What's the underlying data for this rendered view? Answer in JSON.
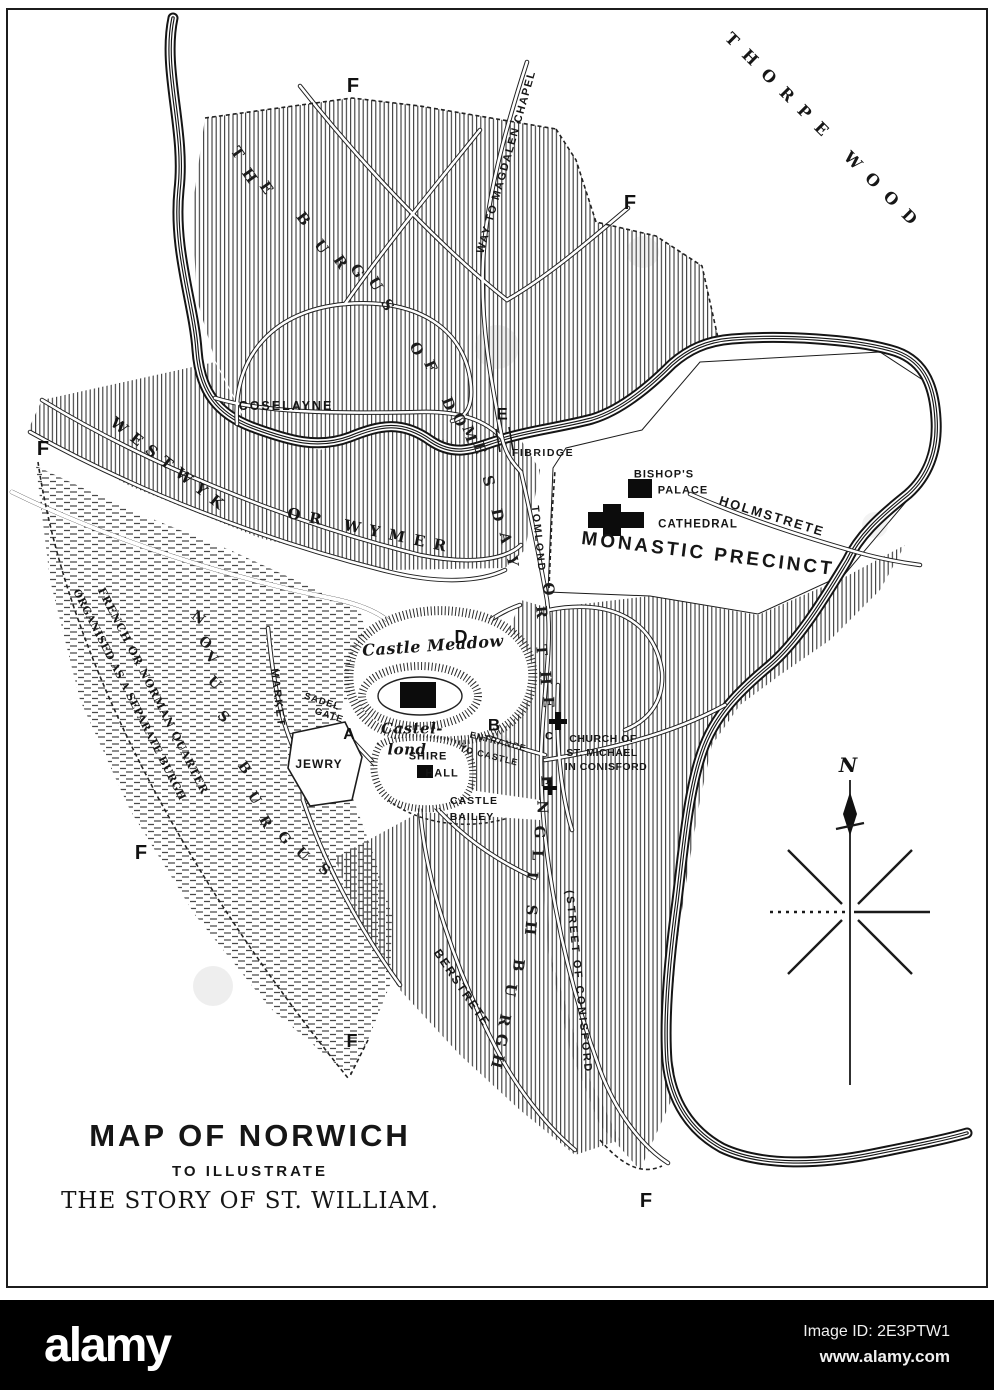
{
  "colors": {
    "ink": "#1a1a1a",
    "paper": "#ffffff",
    "bar": "#000000"
  },
  "title_block": {
    "line1": "MAP OF NORWICH",
    "line2": "TO ILLUSTRATE",
    "line3": "THE STORY OF ST. WILLIAM."
  },
  "compass": {
    "north_label": "N"
  },
  "watermark_bar": {
    "logo": "alamy",
    "image_id": "Image ID: 2E3PTW1",
    "url": "www.alamy.com"
  },
  "map_labels": [
    {
      "id": "thorpe-wood",
      "text": "THORPE WOOD",
      "x": 825,
      "y": 133,
      "r": 45,
      "fs": 16,
      "ls": 12,
      "cls": "serifb"
    },
    {
      "id": "way-to-magdalen-chapel",
      "text": "WAY TO MAGDALEN CHAPEL",
      "x": 507,
      "y": 162,
      "r": -74,
      "fs": 11,
      "ls": 1.5,
      "cls": "sansb"
    },
    {
      "id": "coselayne",
      "text": "COSELAYNE",
      "x": 286,
      "y": 406,
      "r": 0,
      "fs": 12.5,
      "ls": 2,
      "cls": "sansb"
    },
    {
      "id": "fibridge",
      "text": "FIBRIDGE",
      "x": 543,
      "y": 453,
      "r": 0,
      "fs": 10.5,
      "ls": 1.5,
      "cls": "sansb"
    },
    {
      "id": "bishops-palace-1",
      "text": "BISHOP'S",
      "x": 664,
      "y": 475,
      "r": 0,
      "fs": 11,
      "ls": 1,
      "cls": "sansb"
    },
    {
      "id": "bishops-palace-2",
      "text": "PALACE",
      "x": 683,
      "y": 491,
      "r": 0,
      "fs": 11,
      "ls": 1,
      "cls": "sansb"
    },
    {
      "id": "holmstrete",
      "text": "HOLMSTRETE",
      "x": 772,
      "y": 516,
      "r": 17,
      "fs": 13,
      "ls": 2,
      "cls": "sansb"
    },
    {
      "id": "cathedral",
      "text": "CATHEDRAL",
      "x": 698,
      "y": 525,
      "r": 0,
      "fs": 11.5,
      "ls": 1,
      "cls": "sansb"
    },
    {
      "id": "monastic-precinct",
      "text": "MONASTIC PRECINCT",
      "x": 708,
      "y": 554,
      "r": 7,
      "fs": 19,
      "ls": 3,
      "cls": "sansb"
    },
    {
      "id": "westwyk",
      "text": "WESTWYK",
      "x": 170,
      "y": 466,
      "r": 38,
      "fs": 15,
      "ls": 8,
      "cls": "serifb"
    },
    {
      "id": "or-wymer",
      "text": "OR WYMER",
      "x": 371,
      "y": 531,
      "r": 12,
      "fs": 15,
      "ls": 9,
      "cls": "serifb"
    },
    {
      "id": "market",
      "text": "MARKET",
      "x": 277,
      "y": 698,
      "r": 83,
      "fs": 11,
      "ls": 2,
      "cls": "sansb"
    },
    {
      "id": "sadelgate-1",
      "text": "SADEL",
      "x": 322,
      "y": 702,
      "r": 18,
      "fs": 9.5,
      "ls": 1,
      "cls": "sansb"
    },
    {
      "id": "sadelgate-2",
      "text": "GATE",
      "x": 329,
      "y": 716,
      "r": 18,
      "fs": 9.5,
      "ls": 1,
      "cls": "sansb"
    },
    {
      "id": "jewry",
      "text": "JEWRY",
      "x": 319,
      "y": 764,
      "r": 0,
      "fs": 12,
      "ls": 1,
      "cls": "sansb"
    },
    {
      "id": "castle-meadow",
      "text": "Castle Meadow",
      "x": 433,
      "y": 646,
      "r": -4,
      "fs": 16,
      "ls": 0.5,
      "cls": "serifbi"
    },
    {
      "id": "castel-lond-1",
      "text": "Castel-",
      "x": 412,
      "y": 729,
      "r": 0,
      "fs": 15,
      "ls": 0.5,
      "cls": "serifbi"
    },
    {
      "id": "castel-lond-2",
      "text": "lond",
      "x": 407,
      "y": 750,
      "r": 0,
      "fs": 15,
      "ls": 0.5,
      "cls": "serifbi"
    },
    {
      "id": "shire-hall-1",
      "text": "SHIRE",
      "x": 428,
      "y": 757,
      "r": 0,
      "fs": 11,
      "ls": 1,
      "cls": "sansb"
    },
    {
      "id": "shire-hall-2",
      "text": "HALL",
      "x": 442,
      "y": 774,
      "r": 0,
      "fs": 11,
      "ls": 1,
      "cls": "sansb"
    },
    {
      "id": "castle-bailey-1",
      "text": "CASTLE",
      "x": 474,
      "y": 801,
      "r": 0,
      "fs": 10.5,
      "ls": 1,
      "cls": "sansb"
    },
    {
      "id": "castle-bailey-2",
      "text": "BAILEY",
      "x": 472,
      "y": 817,
      "r": 0,
      "fs": 10.5,
      "ls": 1,
      "cls": "sansb"
    },
    {
      "id": "entrance",
      "text": "ENTRANCE",
      "x": 498,
      "y": 742,
      "r": 14,
      "fs": 9,
      "ls": 1,
      "cls": "sansb"
    },
    {
      "id": "to-castle",
      "text": "TO CASTLE",
      "x": 489,
      "y": 756,
      "r": 14,
      "fs": 9,
      "ls": 1,
      "cls": "sansb"
    },
    {
      "id": "church-st-michael-1",
      "text": "CHURCH OF",
      "x": 603,
      "y": 739,
      "r": 0,
      "fs": 10.5,
      "ls": 0.5,
      "cls": "sansb"
    },
    {
      "id": "church-st-michael-2",
      "text": "ST. MICHAEL",
      "x": 602,
      "y": 753,
      "r": 0,
      "fs": 10.5,
      "ls": 0.5,
      "cls": "sansb"
    },
    {
      "id": "church-st-michael-3",
      "text": "IN CONISFORD",
      "x": 606,
      "y": 767,
      "r": 0,
      "fs": 10.5,
      "ls": 0.5,
      "cls": "sansb"
    },
    {
      "id": "berstrete",
      "text": "BERSTRETE",
      "x": 462,
      "y": 988,
      "r": 56,
      "fs": 12,
      "ls": 2,
      "cls": "sansb"
    },
    {
      "id": "street-of-conisford",
      "text": "(STREET OF CONISFORD",
      "x": 578,
      "y": 982,
      "r": 84,
      "fs": 11,
      "ls": 2.5,
      "cls": "sansb"
    },
    {
      "id": "tomlond",
      "text": "TOMLOND",
      "x": 538,
      "y": 539,
      "r": 84,
      "fs": 10.5,
      "ls": 2,
      "cls": "sansb"
    },
    {
      "id": "french-quarter-1",
      "text": "FRENCH OR NORMAN QUARTER",
      "x": 153,
      "y": 691,
      "r": 63,
      "fs": 11,
      "ls": 1,
      "cls": "serifb"
    },
    {
      "id": "french-quarter-2",
      "text": "ORGANISED AS A SEPARATE BURGH",
      "x": 129,
      "y": 695,
      "r": 63,
      "fs": 10.5,
      "ls": 0.5,
      "cls": "serifb"
    }
  ],
  "winding_letters": [
    {
      "id": "burgus-1",
      "t": "T",
      "x": 237,
      "y": 153,
      "r": 55,
      "fs": 15
    },
    {
      "id": "burgus-2",
      "t": "H",
      "x": 249,
      "y": 176,
      "r": 55,
      "fs": 15
    },
    {
      "id": "burgus-3",
      "t": "E",
      "x": 266,
      "y": 188,
      "r": 55,
      "fs": 15
    },
    {
      "id": "burgus-4",
      "t": "B",
      "x": 303,
      "y": 219,
      "r": 52,
      "fs": 15
    },
    {
      "id": "burgus-5",
      "t": "U",
      "x": 321,
      "y": 247,
      "r": 54,
      "fs": 15
    },
    {
      "id": "burgus-6",
      "t": "R",
      "x": 340,
      "y": 262,
      "r": 56,
      "fs": 15
    },
    {
      "id": "burgus-7",
      "t": "G",
      "x": 357,
      "y": 271,
      "r": 58,
      "fs": 15
    },
    {
      "id": "burgus-8",
      "t": "U",
      "x": 375,
      "y": 284,
      "r": 60,
      "fs": 15
    },
    {
      "id": "burgus-9",
      "t": "S",
      "x": 387,
      "y": 305,
      "r": 62,
      "fs": 15
    },
    {
      "id": "burgus-10",
      "t": "O",
      "x": 416,
      "y": 349,
      "r": 64,
      "fs": 15
    },
    {
      "id": "burgus-11",
      "t": "F",
      "x": 430,
      "y": 366,
      "r": 66,
      "fs": 15
    },
    {
      "id": "burgus-12",
      "t": "D",
      "x": 448,
      "y": 404,
      "r": 68,
      "fs": 15
    },
    {
      "id": "burgus-13",
      "t": "O",
      "x": 459,
      "y": 420,
      "r": 70,
      "fs": 15
    },
    {
      "id": "burgus-14",
      "t": "M",
      "x": 469,
      "y": 434,
      "r": 72,
      "fs": 15
    },
    {
      "id": "burgus-15",
      "t": "E",
      "x": 479,
      "y": 448,
      "r": 74,
      "fs": 15
    },
    {
      "id": "burgus-16",
      "t": "S",
      "x": 488,
      "y": 481,
      "r": 76,
      "fs": 15
    },
    {
      "id": "burgus-17",
      "t": "D",
      "x": 497,
      "y": 515,
      "r": 78,
      "fs": 15
    },
    {
      "id": "burgus-18",
      "t": "A",
      "x": 505,
      "y": 538,
      "r": 80,
      "fs": 15
    },
    {
      "id": "burgus-19",
      "t": "Y",
      "x": 512,
      "y": 561,
      "r": 82,
      "fs": 15
    },
    {
      "id": "burgus-20",
      "t": "O",
      "x": 548,
      "y": 589,
      "r": 84,
      "fs": 15
    },
    {
      "id": "burgus-21",
      "t": "R",
      "x": 541,
      "y": 612,
      "r": 85,
      "fs": 15
    },
    {
      "id": "burgus-22",
      "t": "T",
      "x": 541,
      "y": 650,
      "r": 86,
      "fs": 15
    },
    {
      "id": "burgus-23",
      "t": "H",
      "x": 545,
      "y": 678,
      "r": 87,
      "fs": 15
    },
    {
      "id": "burgus-24",
      "t": "E",
      "x": 548,
      "y": 702,
      "r": 88,
      "fs": 15
    },
    {
      "id": "burgus-25",
      "t": "E",
      "x": 546,
      "y": 781,
      "r": 88,
      "fs": 15
    },
    {
      "id": "burgus-26",
      "t": "N",
      "x": 542,
      "y": 807,
      "r": 89,
      "fs": 15
    },
    {
      "id": "burgus-27",
      "t": "G",
      "x": 539,
      "y": 832,
      "r": 90,
      "fs": 15
    },
    {
      "id": "burgus-28",
      "t": "L",
      "x": 537,
      "y": 855,
      "r": 91,
      "fs": 15
    },
    {
      "id": "burgus-29",
      "t": "I",
      "x": 532,
      "y": 875,
      "r": 92,
      "fs": 15
    },
    {
      "id": "burgus-30",
      "t": "S",
      "x": 531,
      "y": 910,
      "r": 94,
      "fs": 15
    },
    {
      "id": "burgus-31",
      "t": "H",
      "x": 530,
      "y": 928,
      "r": 96,
      "fs": 15
    },
    {
      "id": "burgus-32",
      "t": "B",
      "x": 518,
      "y": 965,
      "r": 98,
      "fs": 15
    },
    {
      "id": "burgus-33",
      "t": "U",
      "x": 510,
      "y": 990,
      "r": 100,
      "fs": 15
    },
    {
      "id": "burgus-34",
      "t": "R",
      "x": 504,
      "y": 1020,
      "r": 102,
      "fs": 15
    },
    {
      "id": "burgus-35",
      "t": "G",
      "x": 501,
      "y": 1040,
      "r": 104,
      "fs": 15
    },
    {
      "id": "burgus-36",
      "t": "H",
      "x": 497,
      "y": 1061,
      "r": 106,
      "fs": 15
    },
    {
      "id": "novus-1",
      "t": "N",
      "x": 198,
      "y": 618,
      "r": 38,
      "fs": 14
    },
    {
      "id": "novus-2",
      "t": "O",
      "x": 205,
      "y": 643,
      "r": 40,
      "fs": 14
    },
    {
      "id": "novus-3",
      "t": "V",
      "x": 211,
      "y": 658,
      "r": 42,
      "fs": 14
    },
    {
      "id": "novus-4",
      "t": "U",
      "x": 214,
      "y": 683,
      "r": 44,
      "fs": 14
    },
    {
      "id": "novus-5",
      "t": "S",
      "x": 223,
      "y": 717,
      "r": 46,
      "fs": 14
    },
    {
      "id": "novus-6",
      "t": "B",
      "x": 244,
      "y": 768,
      "r": 54,
      "fs": 14
    },
    {
      "id": "novus-7",
      "t": "U",
      "x": 254,
      "y": 798,
      "r": 58,
      "fs": 14
    },
    {
      "id": "novus-8",
      "t": "R",
      "x": 265,
      "y": 822,
      "r": 60,
      "fs": 14
    },
    {
      "id": "novus-9",
      "t": "G",
      "x": 284,
      "y": 838,
      "r": 52,
      "fs": 14
    },
    {
      "id": "novus-10",
      "t": "U",
      "x": 302,
      "y": 854,
      "r": 46,
      "fs": 14
    },
    {
      "id": "novus-11",
      "t": "S",
      "x": 324,
      "y": 870,
      "r": 40,
      "fs": 14
    }
  ],
  "markers": [
    {
      "id": "marker-f-northwest",
      "text": "F",
      "x": 353,
      "y": 86,
      "fs": 20
    },
    {
      "id": "marker-f-northeast",
      "text": "F",
      "x": 630,
      "y": 203,
      "fs": 20
    },
    {
      "id": "marker-f-west",
      "text": "F",
      "x": 43,
      "y": 449,
      "fs": 20
    },
    {
      "id": "marker-f-southwest",
      "text": "F",
      "x": 141,
      "y": 853,
      "fs": 20
    },
    {
      "id": "marker-f-south",
      "text": "F",
      "x": 352,
      "y": 1041,
      "fs": 18
    },
    {
      "id": "marker-f-southeast",
      "text": "F",
      "x": 646,
      "y": 1201,
      "fs": 20
    },
    {
      "id": "marker-e-fibridge",
      "text": "E",
      "x": 502,
      "y": 414,
      "fs": 17
    },
    {
      "id": "marker-d-castle-meadow",
      "text": "D",
      "x": 461,
      "y": 637,
      "fs": 18
    },
    {
      "id": "marker-a-sadelgate",
      "text": "A",
      "x": 349,
      "y": 735,
      "fs": 16
    },
    {
      "id": "marker-b-castle-entrance",
      "text": "B",
      "x": 494,
      "y": 725,
      "fs": 17
    },
    {
      "id": "marker-c-church",
      "text": "C",
      "x": 549,
      "y": 737,
      "fs": 11
    }
  ]
}
